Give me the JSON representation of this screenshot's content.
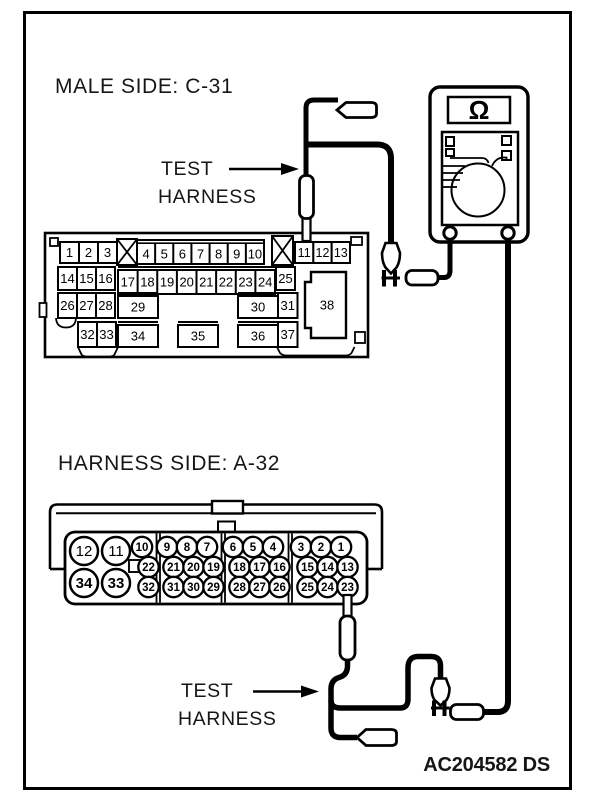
{
  "labels": {
    "male_side_title": "MALE SIDE: C-31",
    "harness_side_title": "HARNESS SIDE: A-32",
    "test_harness_top": [
      "TEST",
      "HARNESS"
    ],
    "test_harness_bottom": [
      "TEST",
      "HARNESS"
    ],
    "figure_code": "AC204582 DS"
  },
  "multimeter": {
    "display_symbol": "Ω",
    "mode": "ohmmeter"
  },
  "connector_c31": {
    "name": "C-31",
    "row1_left": [
      "1",
      "2",
      "3"
    ],
    "row1_mid": [
      "4",
      "5",
      "6",
      "7",
      "8",
      "9",
      "10"
    ],
    "row1_right": [
      "11",
      "12",
      "13"
    ],
    "row2_left": [
      "14",
      "15",
      "16"
    ],
    "row2_mid": [
      "17",
      "18",
      "19",
      "20",
      "21",
      "22",
      "23",
      "24"
    ],
    "row2_right": [
      "25"
    ],
    "row3_left": [
      "26",
      "27",
      "28"
    ],
    "row3_boxes": [
      "29",
      "30"
    ],
    "row3_right": [
      "31"
    ],
    "row4_left": [
      "32",
      "33"
    ],
    "row4_boxes": [
      "34",
      "35",
      "36"
    ],
    "row4_right": [
      "37"
    ],
    "large_pin": "38"
  },
  "connector_a32": {
    "name": "A-32",
    "large_pins": [
      "12",
      "11",
      "34",
      "33"
    ],
    "row1": [
      "10",
      "9",
      "8",
      "7",
      "6",
      "5",
      "4",
      "3",
      "2",
      "1"
    ],
    "row2": [
      "22",
      "21",
      "20",
      "19",
      "18",
      "17",
      "16",
      "15",
      "14",
      "13"
    ],
    "row3": [
      "32",
      "31",
      "30",
      "29",
      "28",
      "27",
      "26",
      "25",
      "24",
      "23"
    ]
  },
  "probes": {
    "c31_probe_pin": "11",
    "a32_probe_pin": "23"
  },
  "colors": {
    "line": "#000000",
    "background": "#ffffff"
  }
}
